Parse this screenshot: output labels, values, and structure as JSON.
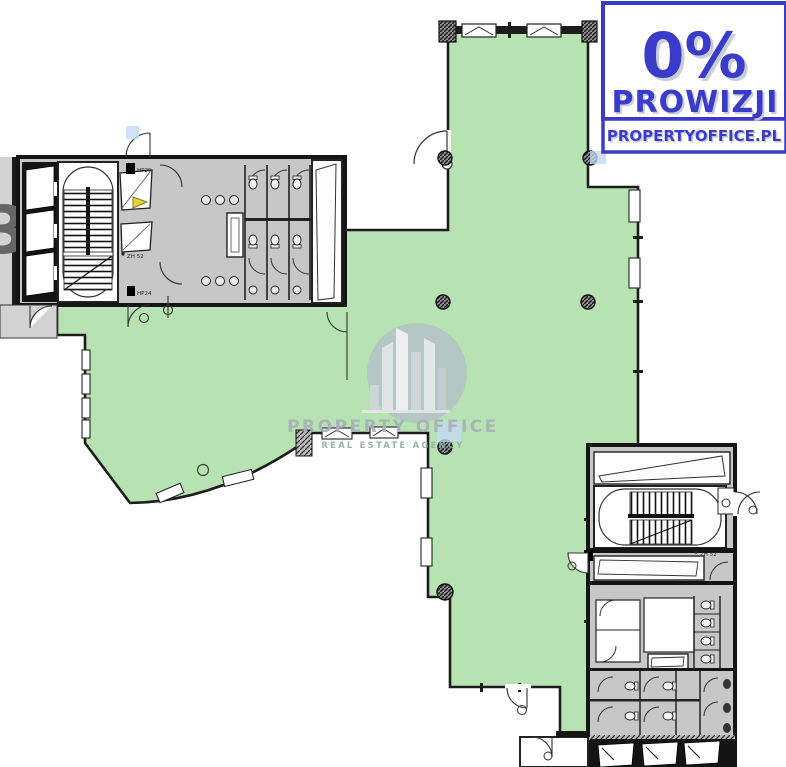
{
  "badge": {
    "headline": "0%",
    "subheadline": "PROWIZJI",
    "website": "PROPERTYOFFICE.PL",
    "accent_color": "#3b3bc9",
    "shadow_color": "#c7cdd9"
  },
  "watermark": {
    "brand": "PROPERTY OFFICE",
    "tagline": "REAL ESTATE AGENCY"
  },
  "plan": {
    "labels": {
      "floor_number": "3",
      "hydrant_label_top": "HP25",
      "fire_zone_label_top": "ZH 52",
      "hydrant_label_mid": "HP24",
      "fire_zone_label_bottom": "ZH 52"
    },
    "colors": {
      "available_area_green": "#b7e3b2",
      "wall_dark": "#1c1c1c",
      "core_gray": "#c7c7c7",
      "outside_gray": "#d3d3d3",
      "marker_yellow": "#e5d243",
      "artifact_blue": "#c3d9f2"
    }
  }
}
